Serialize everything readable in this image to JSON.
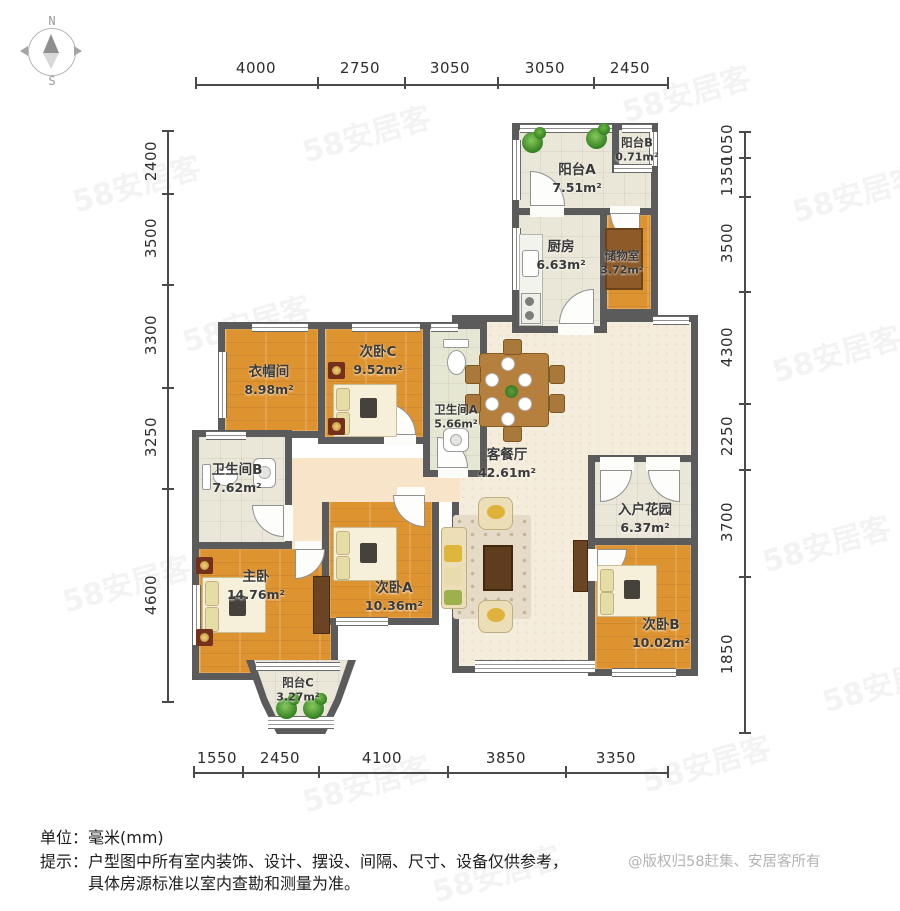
{
  "compass": {
    "north": "N",
    "south": "S"
  },
  "dimensions": {
    "top": [
      "4000",
      "2750",
      "3050",
      "3050",
      "2450"
    ],
    "left": [
      "2400",
      "3500",
      "3300",
      "3250",
      "4600"
    ],
    "right": [
      "1050",
      "1350",
      "3500",
      "4300",
      "2250",
      "3700",
      "1850"
    ],
    "bottom": [
      "1550",
      "2450",
      "4100",
      "3850",
      "3350"
    ]
  },
  "rooms": {
    "balcony_a": {
      "name": "阳台A",
      "area": "7.51m²"
    },
    "balcony_b": {
      "name": "阳台B",
      "area": "0.71m²"
    },
    "kitchen": {
      "name": "厨房",
      "area": "6.63m²"
    },
    "storage": {
      "name": "储物室",
      "area": "3.72m²"
    },
    "cloakroom": {
      "name": "衣帽间",
      "area": "8.98m²"
    },
    "bedroom_c": {
      "name": "次卧C",
      "area": "9.52m²"
    },
    "bath_a": {
      "name": "卫生间A",
      "area": "5.66m²"
    },
    "living": {
      "name": "客餐厅",
      "area": "42.61m²"
    },
    "bath_b": {
      "name": "卫生间B",
      "area": "7.62m²"
    },
    "master": {
      "name": "主卧",
      "area": "14.76m²"
    },
    "bedroom_a": {
      "name": "次卧A",
      "area": "10.36m²"
    },
    "garden": {
      "name": "入户花园",
      "area": "6.37m²"
    },
    "bedroom_b": {
      "name": "次卧B",
      "area": "10.02m²"
    },
    "balcony_c": {
      "name": "阳台C",
      "area": "3.27m²"
    }
  },
  "footer": {
    "unit": "单位：毫米(mm)",
    "hint_line1": "提示：户型图中所有室内装饰、设计、摆设、间隔、尺寸、设备仅供参考，",
    "hint_line2": "具体房源标准以室内查勘和测量为准。",
    "copyright": "@版权归58赶集、安居客所有"
  },
  "watermark": "58安居客",
  "colors": {
    "wall": "#5b5b5b",
    "wood_floor": "#de9331",
    "tile_floor": "#eae7d8",
    "living_floor": "#f5eddc",
    "hall_floor": "#f8e4c8",
    "rug": "#8d5a28"
  }
}
